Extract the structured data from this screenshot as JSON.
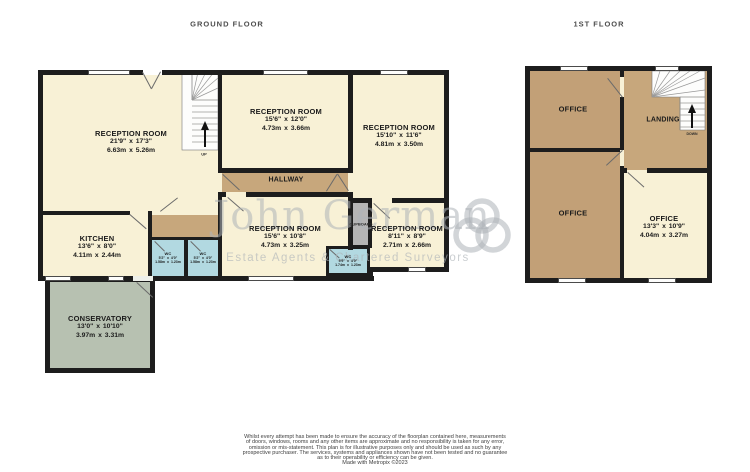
{
  "titles": {
    "ground": "GROUND FLOOR",
    "first": "1ST FLOOR"
  },
  "ground_floor": {
    "rooms": {
      "reception1": {
        "name": "RECEPTION ROOM",
        "imperial": "21'9\" x 17'3\"",
        "metric": "6.63m x 5.26m"
      },
      "reception2": {
        "name": "RECEPTION ROOM",
        "imperial": "15'6\" x 12'0\"",
        "metric": "4.73m x 3.66m"
      },
      "reception3": {
        "name": "RECEPTION ROOM",
        "imperial": "15'10\" x 11'6\"",
        "metric": "4.81m x 3.50m"
      },
      "reception4": {
        "name": "RECEPTION ROOM",
        "imperial": "15'6\" x 10'8\"",
        "metric": "4.73m x 3.25m"
      },
      "reception5": {
        "name": "RECEPTION ROOM",
        "imperial": "8'11\" x 8'9\"",
        "metric": "2.71m x 2.66m"
      },
      "kitchen": {
        "name": "KITCHEN",
        "imperial": "13'6\" x 8'0\"",
        "metric": "4.11m x 2.44m"
      },
      "conservatory": {
        "name": "CONSERVATORY",
        "imperial": "13'0\" x 10'10\"",
        "metric": "3.97m x 3.31m"
      },
      "hallway": {
        "name": "HALLWAY"
      },
      "wc_left1": {
        "name": "WC",
        "imperial": "5'2\" x 4'0\"",
        "metric": "1.58m x 1.23m"
      },
      "wc_left2": {
        "name": "WC",
        "imperial": "5'2\" x 4'0\"",
        "metric": "1.58m x 1.23m"
      },
      "wc_middle": {
        "name": "WC",
        "imperial": "5'9\" x 4'0\"",
        "metric": "1.74m x 1.23m"
      },
      "cupboard": {
        "name": "CUPBOARD"
      },
      "stairs": {
        "direction": "UP"
      }
    }
  },
  "first_floor": {
    "rooms": {
      "office_top": {
        "name": "OFFICE"
      },
      "office_bottom": {
        "name": "OFFICE"
      },
      "office_right": {
        "name": "OFFICE",
        "imperial": "13'3\" x 10'9\"",
        "metric": "4.04m x 3.27m"
      },
      "landing": {
        "name": "LANDING"
      },
      "stairs": {
        "direction": "DOWN"
      }
    }
  },
  "watermark": {
    "name": "John German",
    "tagline": "Estate Agents & Chartered Surveyors"
  },
  "disclaimer": {
    "lines": [
      "Whilst every attempt has been made to ensure the accuracy of the floorplan contained here, measurements",
      "of doors, windows, rooms and any other items are approximate and no responsibility is taken for any error,",
      "omission or mis-statement. This plan is for illustrative purposes only and should be used as such by any",
      "prospective purchaser. The services, systems and appliances shown have not been tested and no guarantee",
      "as to their operability or efficiency can be given."
    ],
    "credit": "Made with Metropix ©2023"
  },
  "colors": {
    "wall": "#1d1d1d",
    "room_cream": "#f8f1d6",
    "hall_brown": "#c7a77c",
    "office_brown": "#c2a077",
    "wc_blue": "#b2d9e1",
    "conservatory_green": "#b7c1b1",
    "cupboard_grey": "#b5b5b5"
  }
}
